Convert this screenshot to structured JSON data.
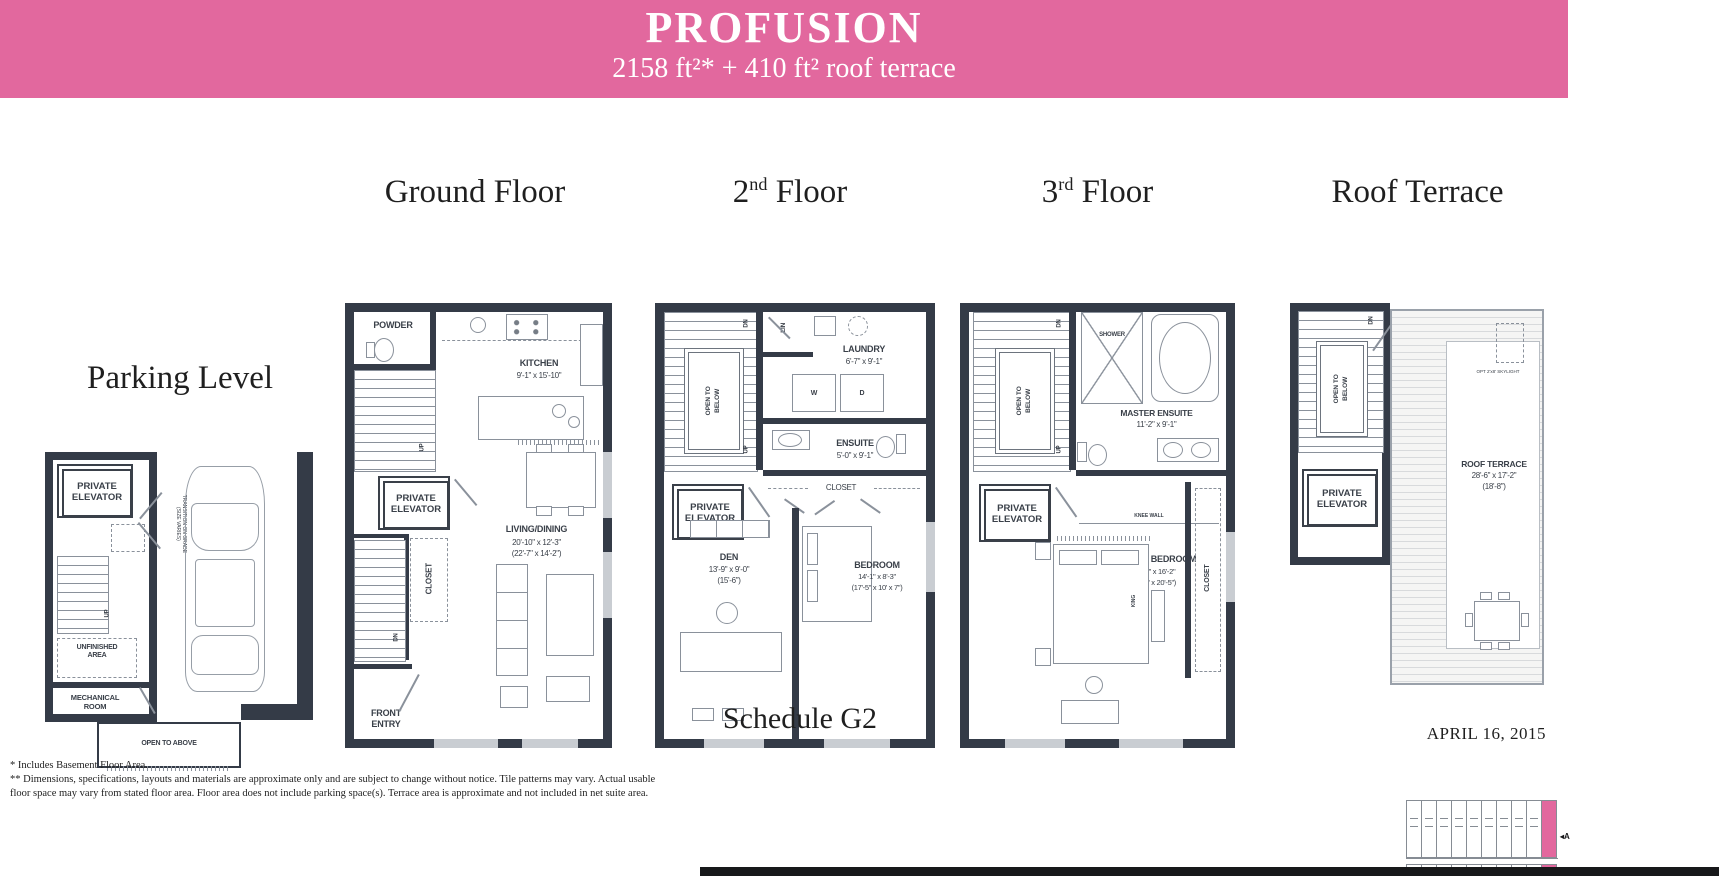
{
  "header": {
    "title": "PROFUSION",
    "subtitle": "2158 ft²* + 410 ft² roof terrace",
    "accent_color": "#E2689E"
  },
  "floors": {
    "parking": {
      "title": "Parking Level",
      "private_elevator": "PRIVATE ELEVATOR",
      "up": "UP",
      "unfinished_area": "UNFINISHED\nAREA",
      "mechanical_room": "MECHANICAL\nROOM",
      "open_to_above": "OPEN TO ABOVE",
      "transition_note": "TRANSITION ON GRADE\n(SIZE VARIES)"
    },
    "ground": {
      "title": "Ground Floor",
      "powder": "POWDER",
      "kitchen": {
        "name": "KITCHEN",
        "dims": "9'-1\" x 15'-10\""
      },
      "private_elevator": "PRIVATE ELEVATOR",
      "closet": "CLOSET",
      "up": "UP",
      "dn": "DN",
      "living": {
        "name": "LIVING/DINING",
        "dims": "20'-10\" x 12'-3\"",
        "dims2": "(22'-7\" x 14'-2\")"
      },
      "front_entry": "FRONT\nENTRY"
    },
    "second": {
      "title_num": "2",
      "title_sup": "nd",
      "title_rest": " Floor",
      "dn": "DN",
      "up": "UP",
      "open_to_below": "OPEN TO BELOW",
      "lin": "LIN",
      "laundry": {
        "name": "LAUNDRY",
        "dims": "6'-7\" x 9'-1\""
      },
      "washer": "W",
      "dryer": "D",
      "ensuite": {
        "name": "ENSUITE",
        "dims": "5'-0\" x 9'-1\""
      },
      "closet": "CLOSET",
      "private_elevator": "PRIVATE ELEVATOR",
      "den": {
        "name": "DEN",
        "dims": "13'-9\" x 9'-0\"",
        "dims2": "(15'-6\")"
      },
      "bedroom": {
        "name": "BEDROOM",
        "dims": "14'-1\" x 8'-3\"",
        "dims2": "(17'-5\" x 10' x 7\")"
      }
    },
    "third": {
      "title_num": "3",
      "title_sup": "rd",
      "title_rest": " Floor",
      "dn": "DN",
      "up": "UP",
      "open_to_below": "OPEN TO BELOW",
      "shower": "SHOWER",
      "master_ensuite": {
        "name": "MASTER ENSUITE",
        "dims": "11'-2\" x 9'-1\""
      },
      "private_elevator": "PRIVATE ELEVATOR",
      "knee_wall": "KNEE WALL",
      "master_bedroom": {
        "name": "MASTER BEDROOM",
        "dims": "18'-7\" x 16'-2\"",
        "dims2": "(20'-7\" x 20'-5\")"
      },
      "king": "KING",
      "closet": "CLOSET"
    },
    "roof": {
      "title": "Roof Terrace",
      "dn": "DN",
      "open_to_below": "OPEN TO BELOW",
      "private_elevator": "PRIVATE ELEVATOR",
      "terrace": {
        "name": "ROOF TERRACE",
        "dims": "28'-6\" x 17'-2\"",
        "dims2": "(18'-8\")"
      },
      "skylight": "OPT 2'x8' SKYLIGHT"
    }
  },
  "footer": {
    "schedule": "Schedule G2",
    "date": "APRIL 16, 2015",
    "notes": [
      "* Includes Basement Floor Area.",
      "** Dimensions, specifications, layouts and materials are approximate only and are subject to change without notice. Tile patterns may vary. Actual usable",
      "floor space may vary from stated floor area. Floor area does not include parking space(s). Terrace area is approximate and not included in net suite area."
    ],
    "keyplan_marker": "A"
  }
}
